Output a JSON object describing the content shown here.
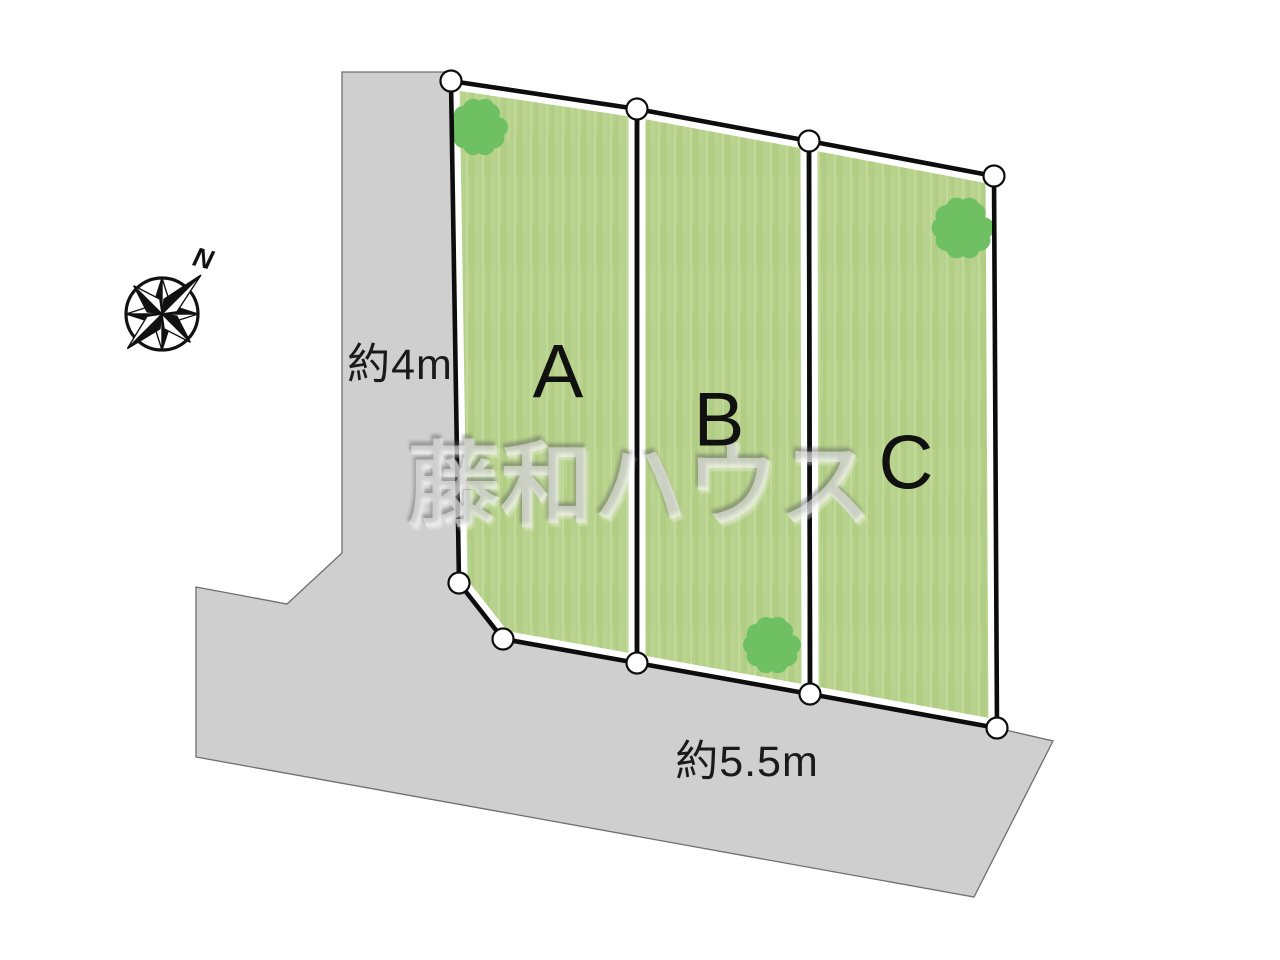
{
  "diagram": {
    "watermark_text": "藤和ハウス",
    "compass": {
      "north_label": "N"
    },
    "roads": {
      "vertical_width_label": "約4m",
      "horizontal_width_label": "約5.5m"
    },
    "lots": [
      {
        "label": "A"
      },
      {
        "label": "B"
      },
      {
        "label": "C"
      }
    ],
    "colors": {
      "road_fill": "#d0cfd0",
      "road_edge": "#6f6f6f",
      "lot_fill": "#b7d28c",
      "lot_border": "#0d0d0d",
      "lot_gap": "#ffffff",
      "tree_fill": "#6fc063",
      "vertex_marker_fill": "#ffffff"
    }
  }
}
